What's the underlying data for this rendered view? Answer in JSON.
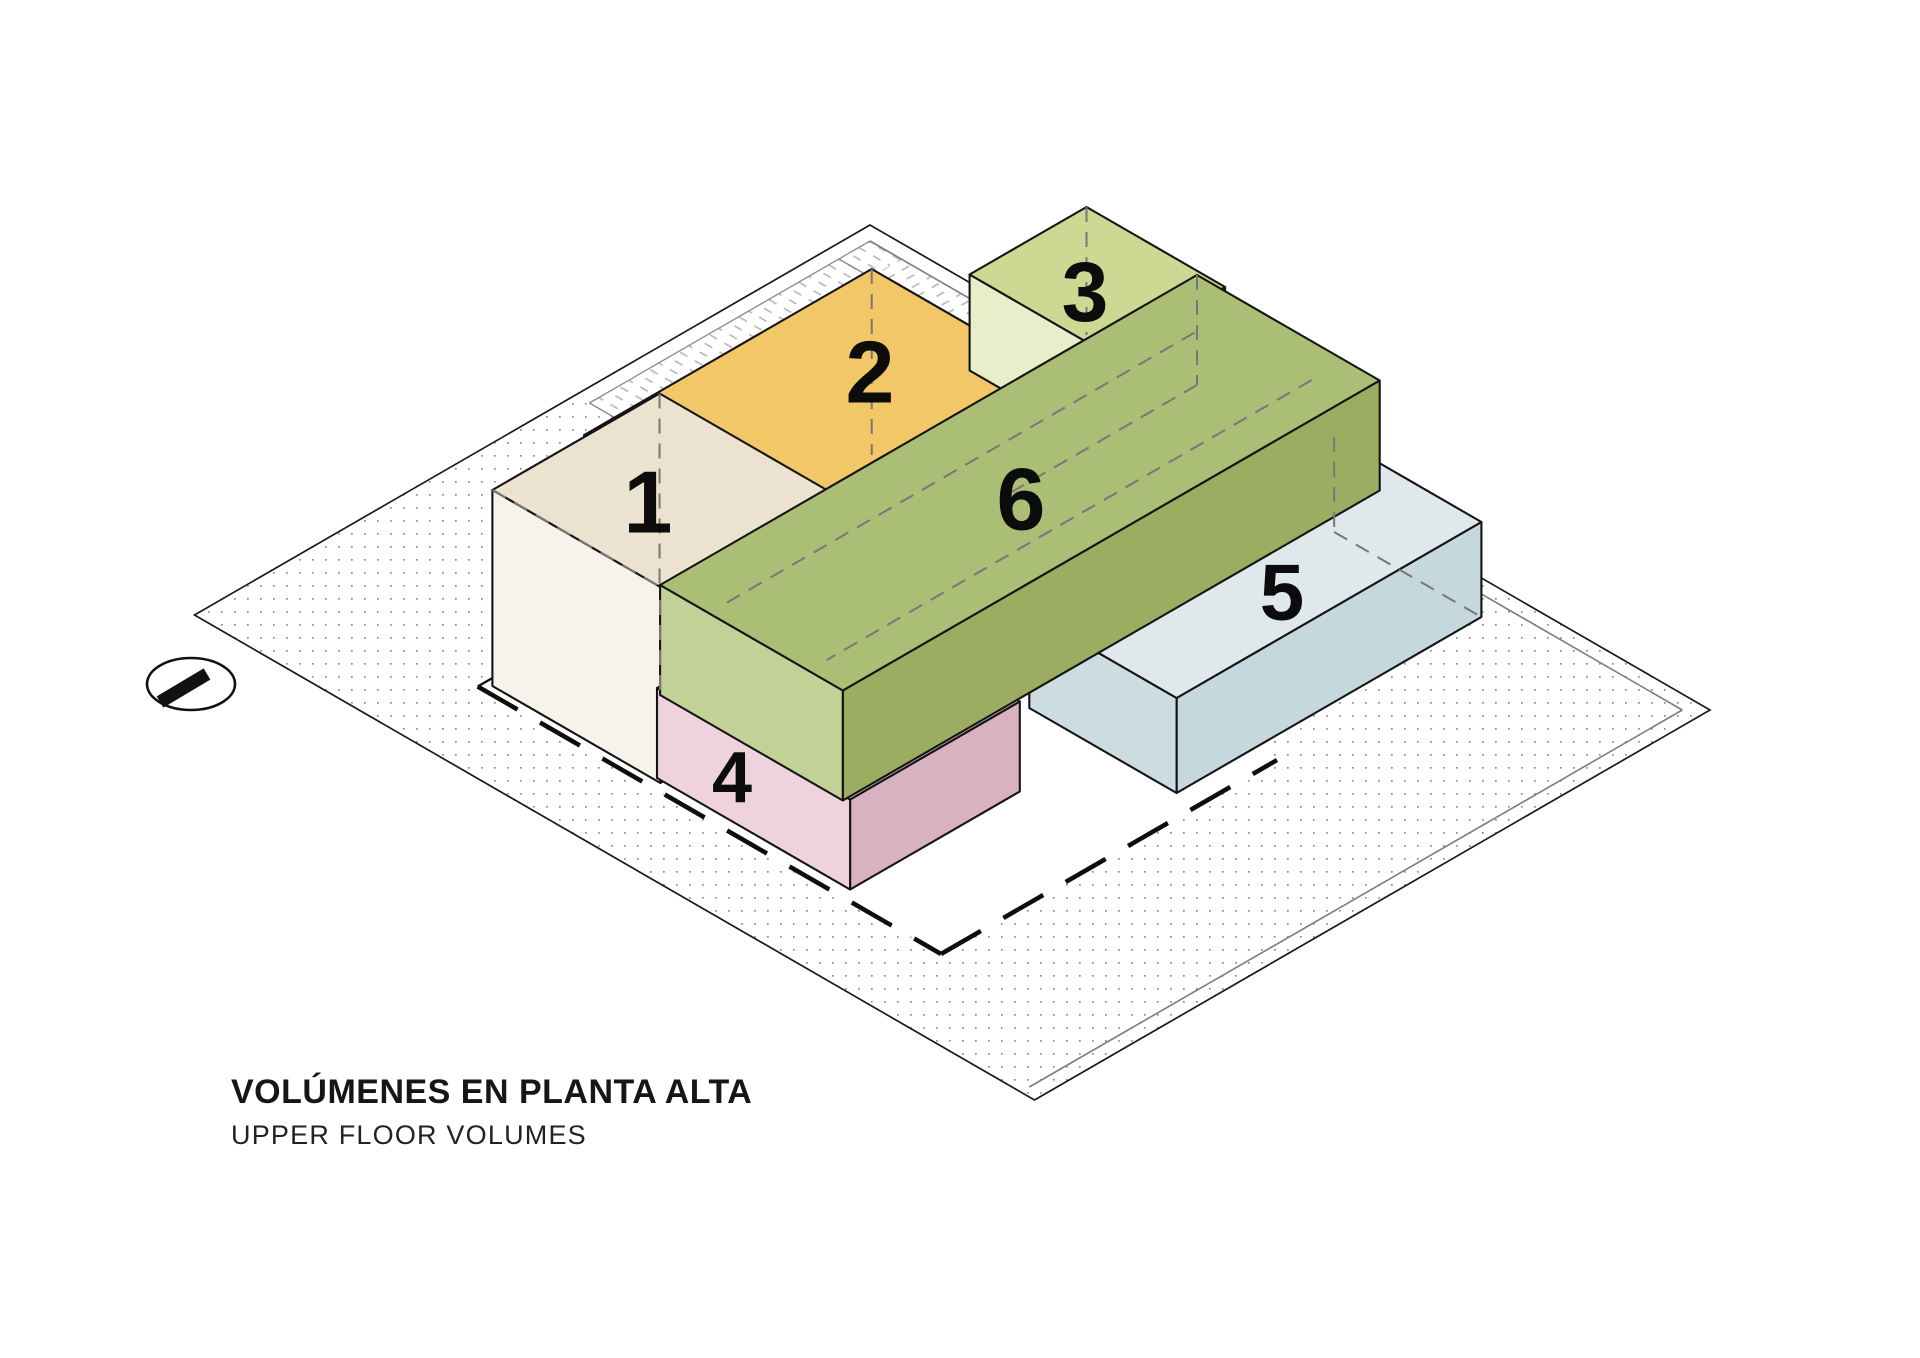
{
  "titles": {
    "main": "VOLÚMENES EN PLANTA ALTA",
    "sub": "UPPER FLOOR VOLUMES"
  },
  "canvas": {
    "w": 1920,
    "h": 1358,
    "bg": "#ffffff"
  },
  "iso": {
    "ox": 870,
    "oy": 225,
    "cos": 0.866,
    "sin": 0.5
  },
  "site": {
    "u": 970,
    "v": 780,
    "outline": "#1a1a1a",
    "outline_w": 1.7,
    "dot_color": "#8c8c8c",
    "dot_size": 1.7,
    "dot_gap": 13
  },
  "sidewalk": {
    "line_color": "#8a8a8a",
    "line_w": 1.3,
    "hatch_color": "#b5b5b5",
    "white_bands": [
      {
        "poly": [
          [
            0,
            0
          ],
          [
            520,
            0
          ],
          [
            520,
            16
          ],
          [
            0,
            16
          ]
        ]
      },
      {
        "poly": [
          [
            0,
            0
          ],
          [
            0,
            340
          ],
          [
            16,
            340
          ],
          [
            16,
            0
          ]
        ]
      }
    ],
    "hatch_bands": [
      {
        "poly": [
          [
            16,
            16
          ],
          [
            520,
            16
          ],
          [
            520,
            52
          ],
          [
            16,
            52
          ]
        ],
        "rot": -30
      },
      {
        "poly": [
          [
            16,
            16
          ],
          [
            16,
            340
          ],
          [
            52,
            340
          ],
          [
            52,
            16
          ]
        ],
        "rot": 30
      }
    ],
    "lines": [
      [
        [
          16,
          16
        ],
        [
          520,
          16
        ]
      ],
      [
        [
          16,
          52
        ],
        [
          520,
          52
        ]
      ],
      [
        [
          520,
          16
        ],
        [
          520,
          52
        ]
      ],
      [
        [
          16,
          16
        ],
        [
          16,
          340
        ]
      ],
      [
        [
          52,
          52
        ],
        [
          52,
          340
        ]
      ],
      [
        [
          16,
          340
        ],
        [
          52,
          340
        ]
      ]
    ]
  },
  "inner_edge_lines": {
    "color": "#7d7d7d",
    "width": 1.6,
    "segments": [
      [
        [
          16,
          16
        ],
        [
          954,
          16
        ]
      ],
      [
        [
          954,
          16
        ],
        [
          954,
          770
        ]
      ]
    ]
  },
  "footprint": {
    "poly": [
      [
        235,
        300
      ],
      [
        770,
        300
      ],
      [
        770,
        688
      ],
      [
        235,
        688
      ]
    ],
    "fill": "#ffffff",
    "dashed_edges": [
      [
        [
          235,
          688
        ],
        [
          770,
          688
        ]
      ],
      [
        [
          770,
          688
        ],
        [
          770,
          300
        ]
      ]
    ],
    "solid_edges": [
      [
        [
          235,
          600
        ],
        [
          235,
          688
        ]
      ]
    ],
    "dash_color": "#0d0d0d",
    "dash_w": 4.5,
    "dash": "46 26",
    "solid_w": 2.2
  },
  "edge": {
    "color": "#141414",
    "width": 2.1
  },
  "volumes": [
    {
      "name": "volume-2",
      "label": "2",
      "u0": 231,
      "v0": 229,
      "du": 214,
      "dv": 332,
      "zb": 0,
      "zt": 186,
      "top": "#f2c767",
      "sw": "#f4e0a4",
      "se": "#e5b654",
      "label_px": [
        870,
        372
      ],
      "label_size": 88
    },
    {
      "name": "volume-3",
      "label": "3",
      "u0": 293,
      "v0": 43,
      "du": 160,
      "dv": 135,
      "zb": 90,
      "zt": 186,
      "top": "#cdd893",
      "sw": "#e7eec9",
      "se": "#b9c77e",
      "label_px": [
        1085,
        292
      ],
      "label_size": 84
    },
    {
      "name": "volume-5",
      "label": "5",
      "u0": 575,
      "v0": 39,
      "du": 170,
      "dv": 352,
      "zb": 0,
      "zt": 95,
      "top": "#dfe9ec",
      "sw": "#cddce1",
      "se": "#c5d8de",
      "label_px": [
        1282,
        592
      ],
      "label_size": 80
    },
    {
      "name": "volume-1",
      "label": "1",
      "u0": 243,
      "v0": 486,
      "du": 194,
      "dv": 193,
      "zb": 0,
      "zt": 196,
      "top": "#ece2d0",
      "sw": "#f7f3ea",
      "se": "#e4d8c4",
      "label_px": [
        648,
        502
      ],
      "label_size": 88
    },
    {
      "name": "volume-4",
      "label": "4",
      "u0": 430,
      "v0": 480,
      "du": 223,
      "dv": 196,
      "zb": 0,
      "zt": 90,
      "top": "#e4c3d0",
      "sw": "#eed3dd",
      "se": "#d9b2c2",
      "label_px": [
        732,
        778
      ],
      "label_size": 72
    },
    {
      "name": "volume-6",
      "label": "6",
      "u0": 438.8,
      "v0": 61.2,
      "du": 211,
      "dv": 620,
      "zb": 90,
      "zt": 200,
      "top": "#abbe76",
      "sw": "#c3d096",
      "se": "#9cad62",
      "label_px": [
        1021,
        499
      ],
      "label_size": 88
    }
  ],
  "hidden_lines": {
    "color": "#777777",
    "width": 2,
    "dash": "15 10",
    "segments": [
      [
        [
          243,
          486,
          196
        ],
        [
          243,
          486,
          0
        ]
      ],
      [
        [
          343.75,
          586.25,
          90
        ],
        [
          343.75,
          586.25,
          0
        ]
      ],
      [
        [
          243,
          679,
          196
        ],
        [
          437,
          679,
          196
        ]
      ],
      [
        [
          231,
          229,
          186
        ],
        [
          231,
          229,
          0
        ]
      ],
      [
        [
          293,
          43,
          186
        ],
        [
          293,
          43,
          58
        ]
      ],
      [
        [
          438.8,
          61.2,
          200
        ],
        [
          438.8,
          61.2,
          90
        ]
      ],
      [
        [
          438.8,
          61.2,
          90
        ],
        [
          438.8,
          289,
          90
        ]
      ],
      [
        [
          495,
          120,
          200
        ],
        [
          495,
          670,
          200
        ]
      ],
      [
        [
          610,
          100,
          200
        ],
        [
          610,
          660,
          200
        ]
      ],
      [
        [
          575,
          39,
          95
        ],
        [
          575,
          39,
          0
        ]
      ],
      [
        [
          575,
          39,
          0
        ],
        [
          745,
          39,
          0
        ]
      ]
    ]
  },
  "marker": {
    "cx": 191,
    "cy": 684,
    "rx": 44,
    "ry": 26,
    "stroke_w": 2.6,
    "bar": [
      [
        160,
        702
      ],
      [
        207,
        674
      ]
    ],
    "bar_w": 13,
    "color": "#111111"
  },
  "label_color": "#0c0c0c"
}
